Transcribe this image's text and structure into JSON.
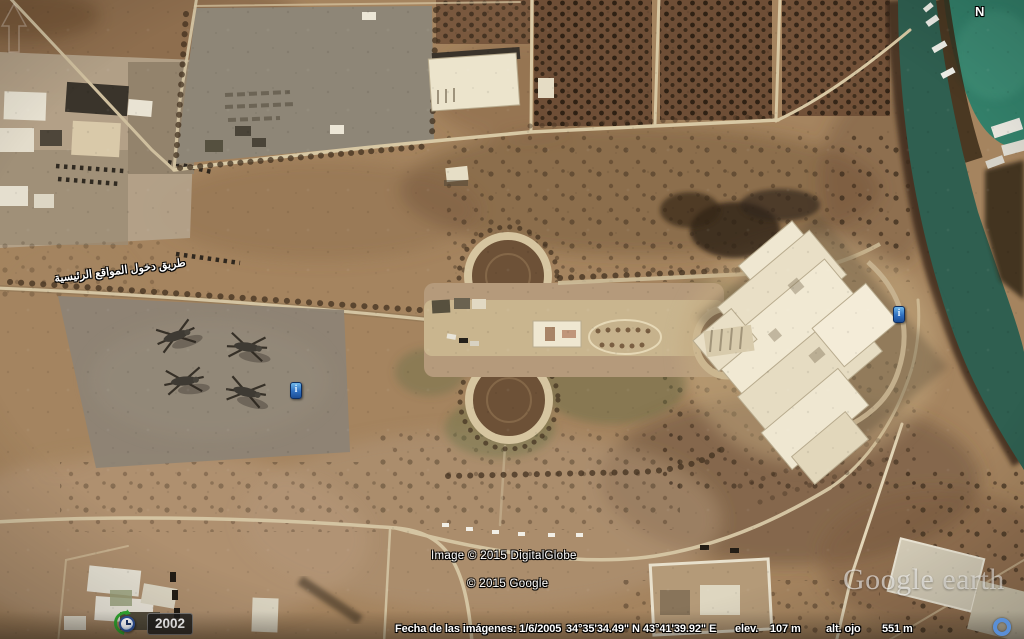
{
  "app_title": "Google Earth",
  "map_overlay": {
    "compass_north": "N",
    "road_label_arabic": "طريق دخول المواقع الرئيسية",
    "imagery_year": "2002",
    "info_marker_glyph": "i",
    "copyright_digitalglobe": "Image © 2015 DigitalGlobe",
    "copyright_google": "© 2015 Google",
    "watermark_google": "Google",
    "watermark_earth": "earth"
  },
  "status_bar": {
    "imagery_date": "Fecha de las imágenes: 1/6/2005",
    "latitude": "34°35'34.49\" N",
    "longitude": "43°41'39.92\" E",
    "elevation_label": "elev.",
    "elevation_value": "107 m",
    "eye_altitude_label": "alt. ojo",
    "eye_altitude_value": "551 m"
  },
  "colors": {
    "terrain": "#a5845f",
    "river_water": "#2f5f50",
    "lagoon_water": "#33806a",
    "marker_blue": "#2f6fc0",
    "streaming_ring_blue": "#5a8fd6"
  }
}
